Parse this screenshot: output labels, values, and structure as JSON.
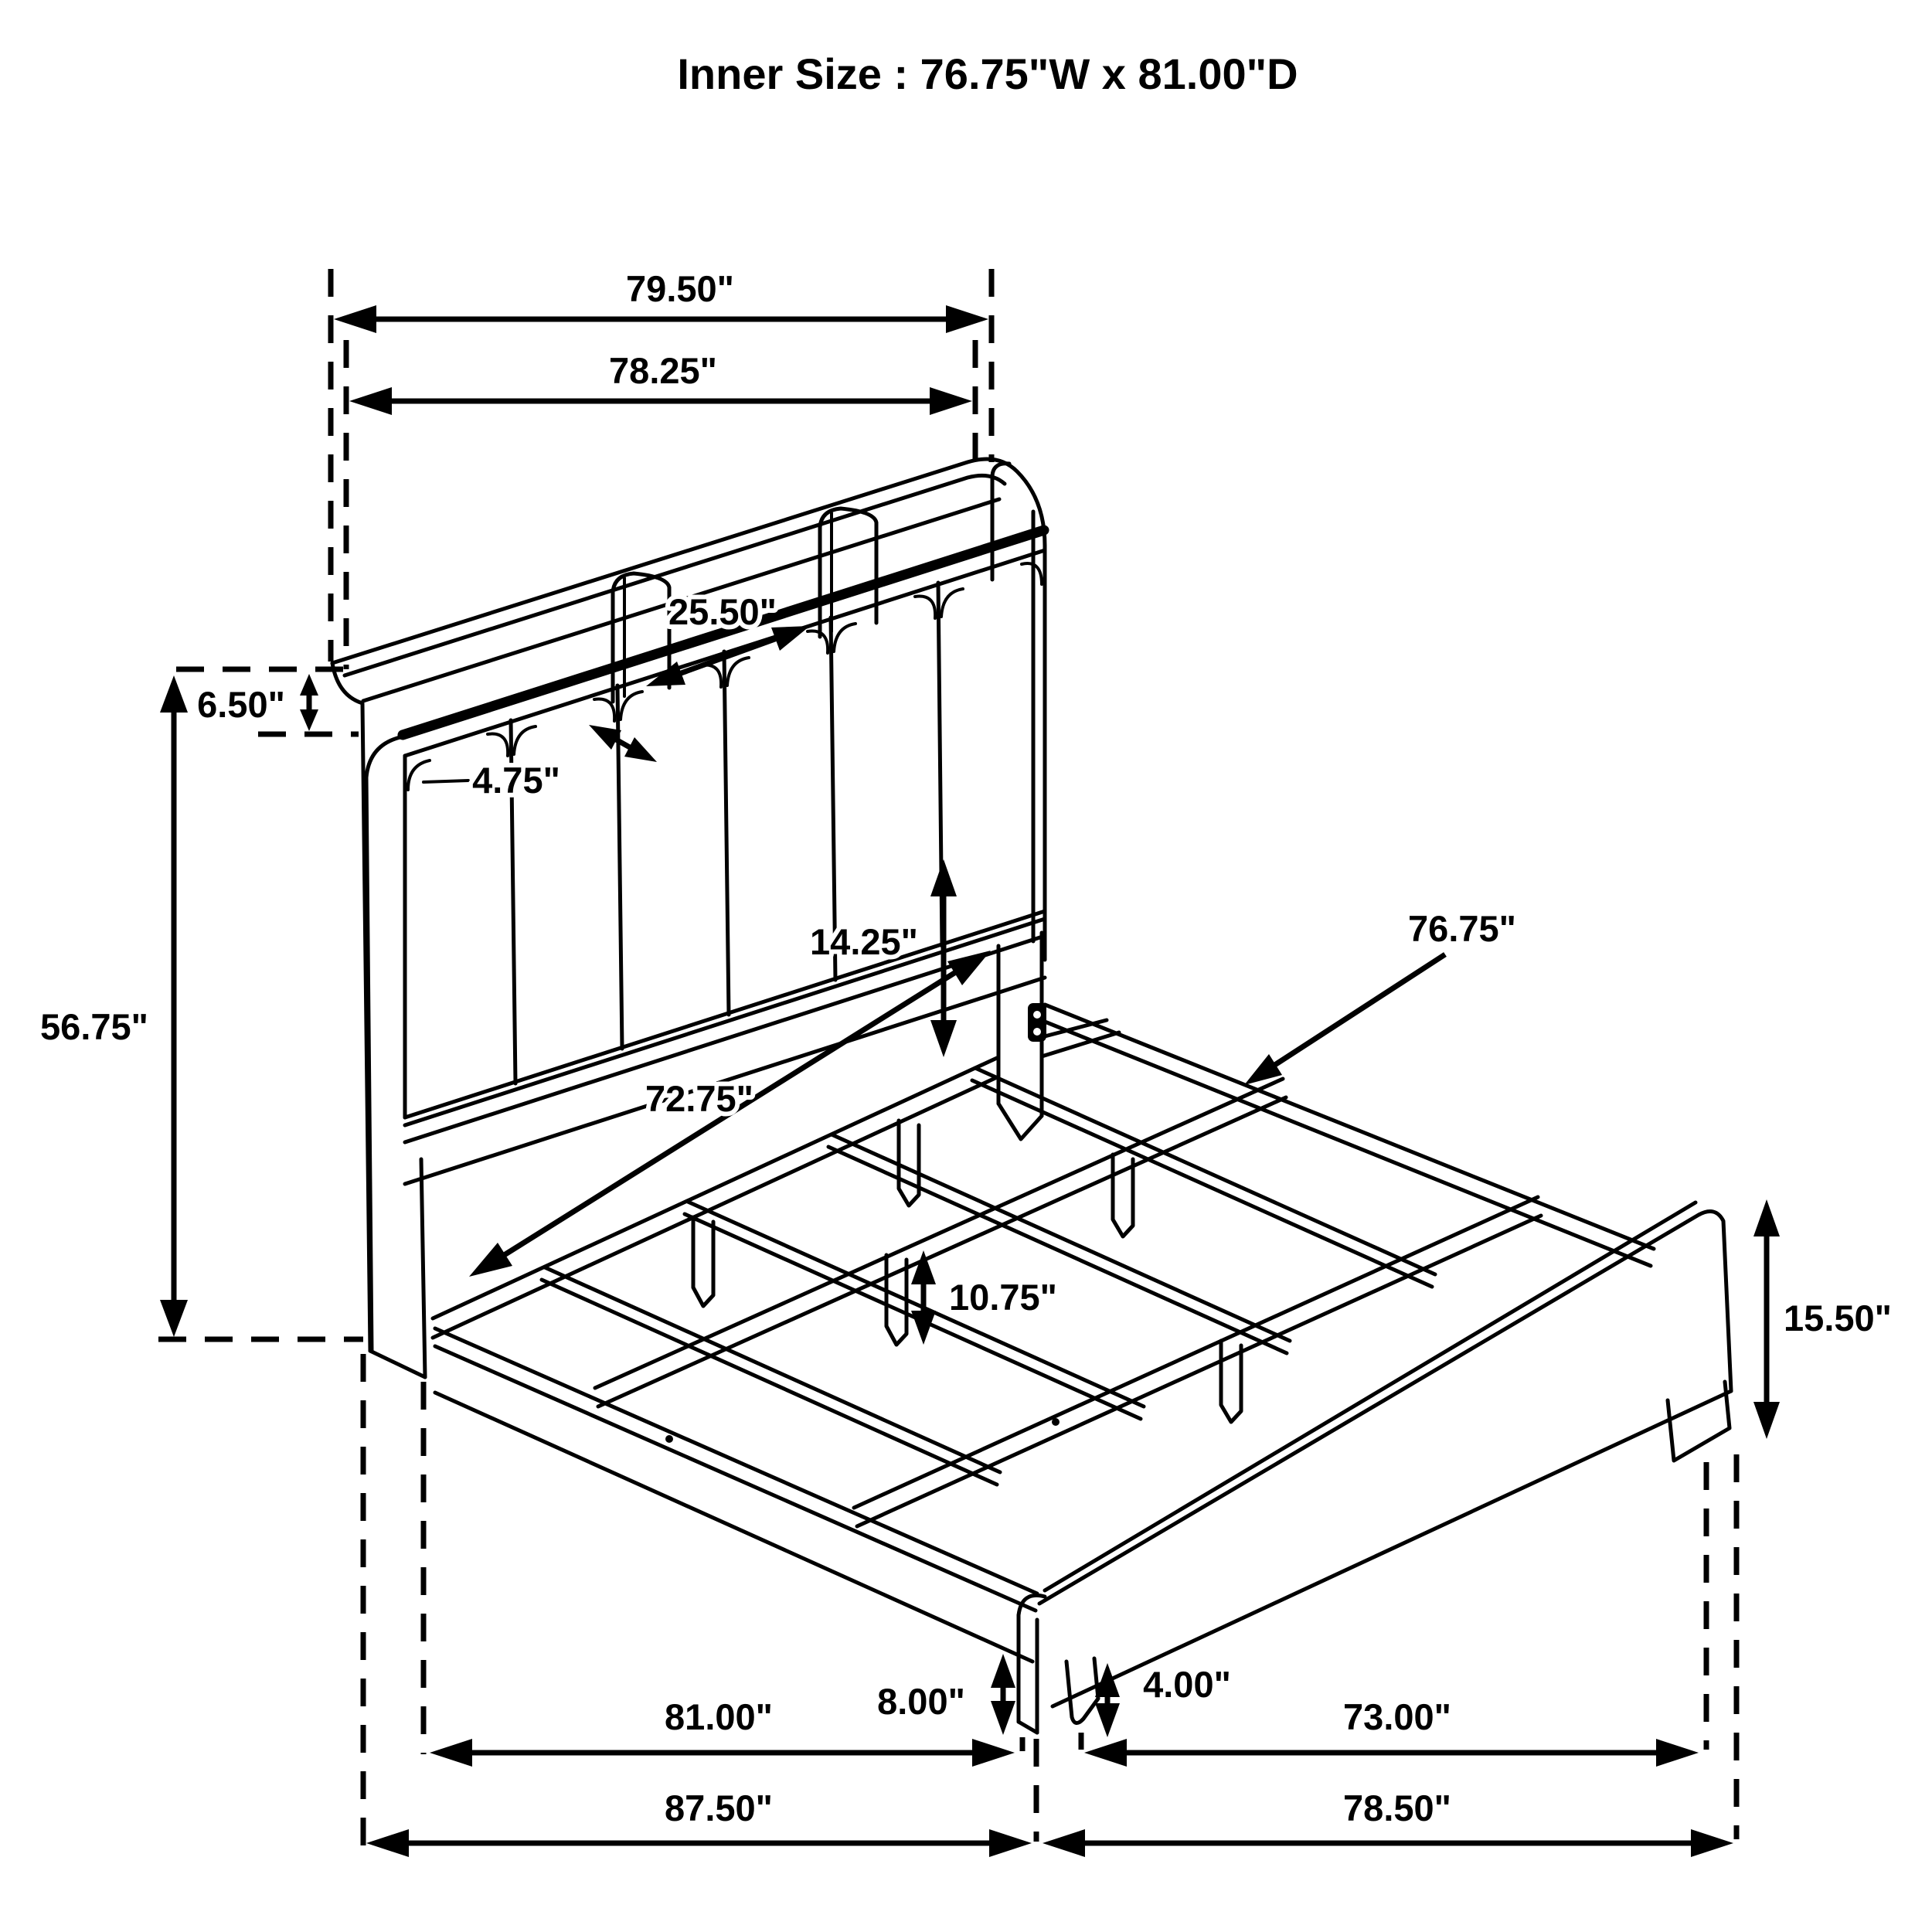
{
  "title": "Inner Size : 76.75\"W x 81.00\"D",
  "dims": {
    "outer_width": "79.50\"",
    "frame_width": "78.25\"",
    "shelf_center_width": "25.50\"",
    "shelf_depth": "4.75\"",
    "shelf_height": "6.50\"",
    "headboard_height": "56.75\"",
    "rail_to_deck_height": "14.25\"",
    "inner_rail_width": "72.75\"",
    "inner_width": "76.75\"",
    "footboard_height": "15.50\"",
    "deck_clearance": "10.75\"",
    "rail_floor_clearance": "8.00\"",
    "leg_height": "4.00\"",
    "inner_depth": "81.00\"",
    "slat_length": "73.00\"",
    "overall_depth": "87.50\"",
    "side_rail_length": "78.50\""
  }
}
